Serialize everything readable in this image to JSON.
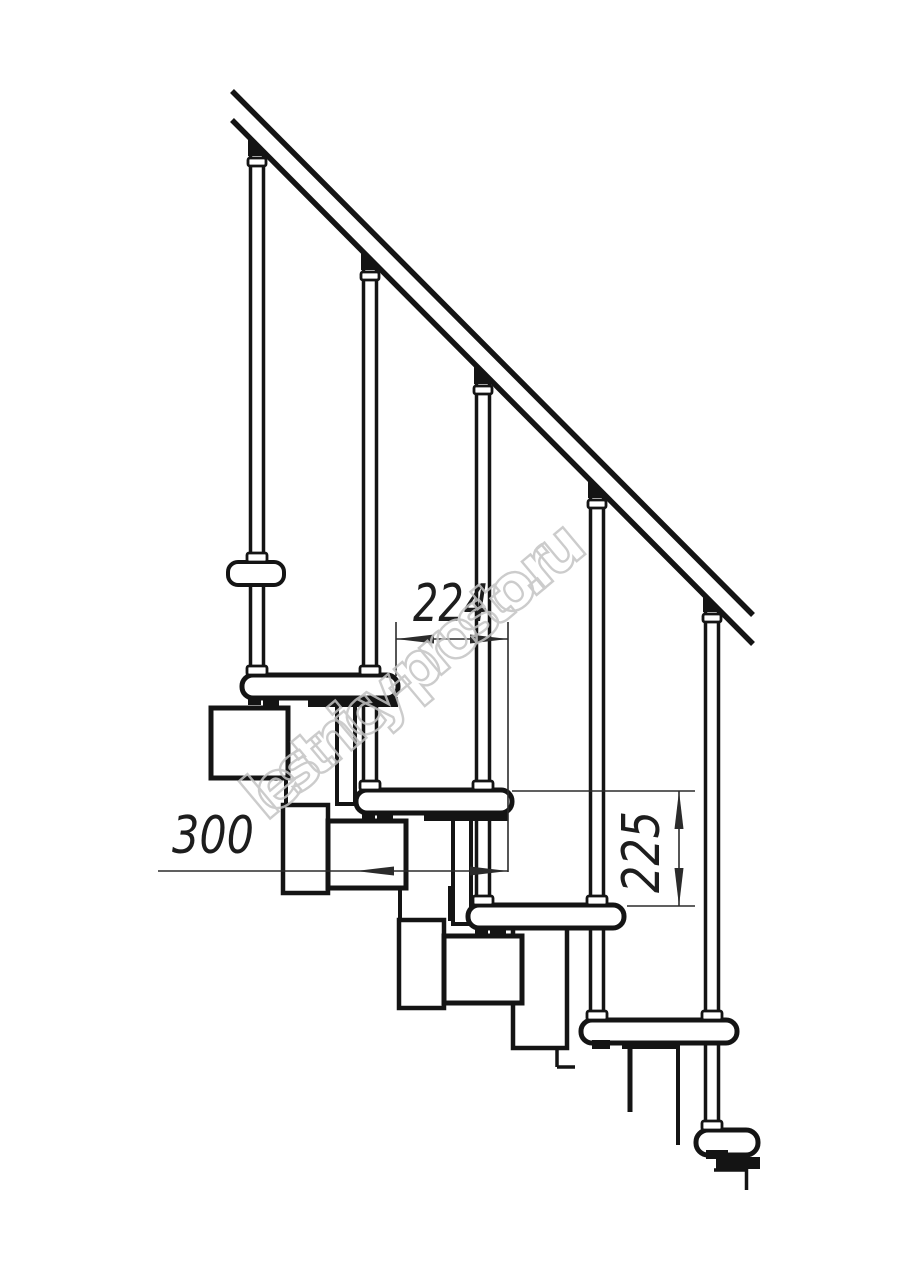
{
  "drawing": {
    "type": "staircase-side-elevation",
    "watermark": "lestnicy-prosto.ru",
    "dimensions": {
      "tread_run": "224",
      "tread_depth": "300",
      "step_rise": "225"
    },
    "colors": {
      "line": "#141414",
      "dimension_line": "#2b2b2b",
      "watermark": "#c4c4c4",
      "background": "#ffffff"
    }
  }
}
